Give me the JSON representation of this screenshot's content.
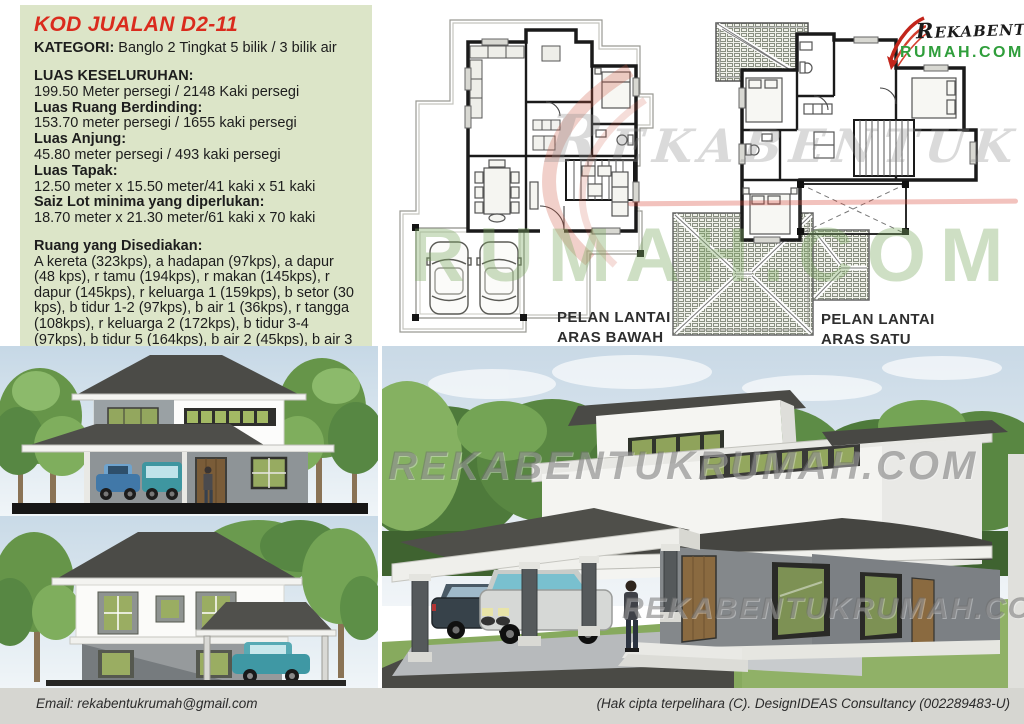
{
  "panel": {
    "title": "KOD JUALAN D2-11",
    "category_label": "KATEGORI:",
    "category_value": " Banglo 2 Tingkat 5 bilik / 3 bilik air",
    "specs": [
      {
        "label": "LUAS KESELURUHAN:",
        "value": "199.50 Meter persegi / 2148 Kaki persegi"
      },
      {
        "label": "Luas Ruang Berdinding:",
        "value": "153.70 meter persegi / 1655 kaki persegi"
      },
      {
        "label": "Luas Anjung:",
        "value": "45.80 meter persegi / 493 kaki persegi"
      },
      {
        "label": "Luas Tapak:",
        "value": "12.50 meter x 15.50 meter/41 kaki x 51 kaki"
      },
      {
        "label": "Saiz Lot minima yang diperlukan:",
        "value": "18.70 meter x 21.30 meter/61 kaki x 70 kaki"
      }
    ],
    "rooms_label": "Ruang yang Disediakan:",
    "rooms_value": "A kereta (323kps), a hadapan (97kps), a dapur (48 kps), r tamu (194kps), r makan (145kps), r dapur (145kps), r keluarga 1 (159kps), b setor (30 kps), b tidur 1-2 (97kps), b air 1 (36kps), r tangga (108kps), r keluarga 2 (172kps), b tidur 3-4 (97kps), b tidur 5 (164kps), b air 2 (45kps), b air 3 (30kps) & balkoni (25kps)"
  },
  "plans": {
    "ground": {
      "label1": "PELAN LANTAI",
      "label2": "ARAS BAWAH"
    },
    "first": {
      "label1": "PELAN LANTAI",
      "label2": "ARAS SATU"
    }
  },
  "logo": {
    "name": "Rekabentuk",
    "domain": "RUMAH.COM"
  },
  "watermarks": {
    "script": "Rekabentuk",
    "domain": "RUMAH.COM",
    "render1": "REKABENTUKRUMAH.COM",
    "render2": "REKABENTUKRUMAH.COM"
  },
  "footer": {
    "email": "Email: rekabentukrumah@gmail.com",
    "copyright": "(Hak cipta terpelihara (C). DesignIDEAS Consultancy (002289483-U)"
  },
  "colors": {
    "accent_red": "#da2b1d",
    "logo_green": "#2f9e3b",
    "panel_bg": "#dce5c8",
    "footer_bg": "#d6d6d1",
    "roof_dark": "#4b4b47"
  }
}
